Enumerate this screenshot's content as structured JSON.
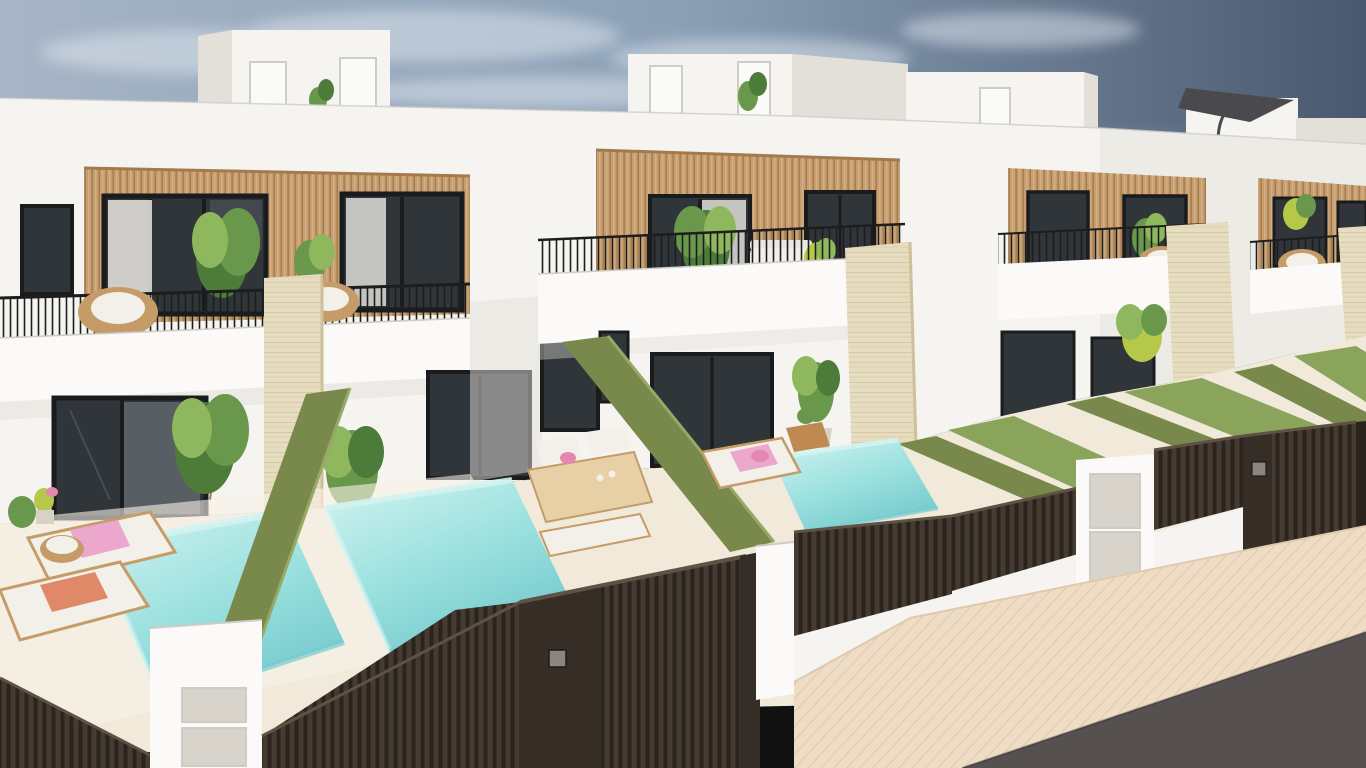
{
  "scene": {
    "type": "architectural-3d-render",
    "description": "3D architectural rendering of a row of modern white two-storey villas with vertical wood-slat facade panels, rooftop access boxes, black-railed balconies with wicker furniture, travertine pillar dividers, private turquoise plunge pools, green artificial-hedge garden walls, dark brown slatted street fences and gates, a beige paved sidewalk and asphalt road in the foreground under a hazy blue sky.",
    "elements": [
      "sky",
      "clouds",
      "grass-field-horizon",
      "rooftop-access-boxes",
      "roof-parasol",
      "villa-row",
      "wood-slat-facades",
      "dark-framed-windows",
      "balcony-railings",
      "wicker-chairs",
      "outdoor-sofa",
      "travertine-pillars",
      "potted-plants",
      "plunge-pools",
      "hedge-walls",
      "artificial-lawns",
      "sun-loungers",
      "pink-towel",
      "coral-towel",
      "outdoor-dining-set",
      "street-fences",
      "entrance-gates",
      "mailbox-pillar",
      "utility-meter-pillar",
      "sidewalk-pavement",
      "asphalt-road"
    ]
  },
  "palette": {
    "sky_left": "#a6b4c6",
    "sky_mid": "#8ba0b6",
    "sky_right": "#49586f",
    "cloud": "#e2e8f0",
    "field": "#7d9b4f",
    "wall": "#f5f4f1",
    "wall_bright": "#fbfaf8",
    "wall_shadow": "#e3e0da",
    "wall_dark": "#cfccc5",
    "wood": "#c79e6f",
    "wood_dark": "#a27a4e",
    "wood_light": "#dcbd92",
    "glass": "#30353a",
    "glass_light": "#5e666d",
    "frame": "#1a1b1d",
    "curtain": "#eae8e3",
    "railing": "#1d1d1d",
    "travertine": "#e6dcc0",
    "travertine_line": "#cfc09c",
    "hedge": "#79894c",
    "hedge_light": "#97a967",
    "lawn": "#8aa45c",
    "pool": "#9ce1df",
    "pool_light": "#d2f3f1",
    "pool_deep": "#76cbce",
    "terrace": "#f1eadb",
    "terrace_light": "#f8f2e7",
    "fence": "#2b241e",
    "fence_bar": "#463b31",
    "fence_hi": "#5f5245",
    "gate_solid": "#362e26",
    "pavement": "#eedcc5",
    "pavement_line": "#dfc9af",
    "road": "#565150",
    "cushion": "#f3f0e9",
    "towel_pink": "#eba7cc",
    "towel_coral": "#df8968",
    "pillow_pink": "#e387ae",
    "furn_wood": "#c59c68",
    "stool_wood": "#bf8a52",
    "table_wood": "#e7d0a6",
    "plant_dark": "#4d7b39",
    "plant": "#69984c",
    "plant_light": "#8fb75e",
    "plant_lime": "#b5c84a",
    "metal_panel": "#d9d4cb",
    "lock": "#8d857c",
    "parasol": "#4a4a4d",
    "door_white": "#fafaf8",
    "pot": "#d8d2c6"
  }
}
